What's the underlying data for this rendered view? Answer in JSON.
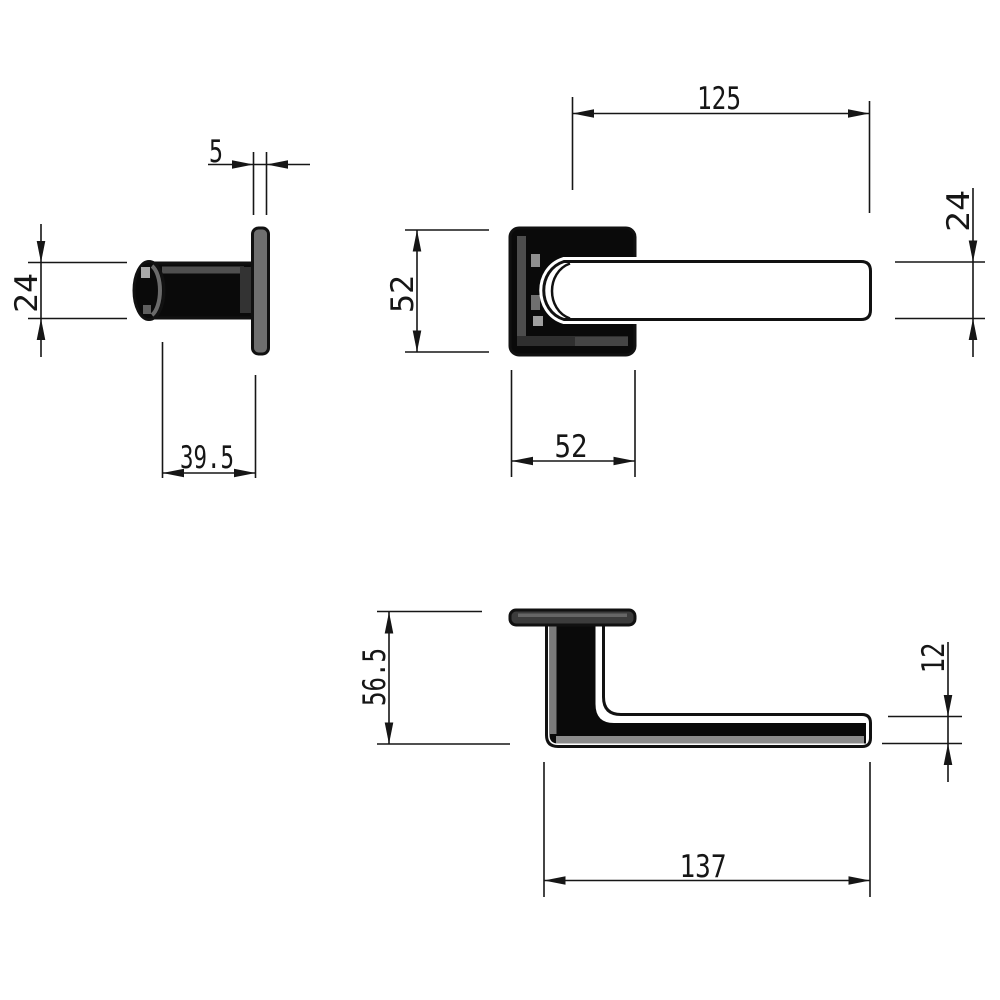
{
  "drawing": {
    "type": "technical-dimension-drawing",
    "subject": "door-lever-handle-three-views",
    "dimensions": {
      "plate_thickness": "5",
      "neck_diameter": "24",
      "neck_projection": "39.5",
      "lever_length": "125",
      "lever_height": "24",
      "rose_height": "52",
      "rose_width": "52",
      "handle_depth": "56.5",
      "lever_thickness": "12",
      "overall_length": "137"
    },
    "colors": {
      "line": "#161616",
      "fill_black": "#0a0a0a",
      "plate_gray": "#6f6f6f",
      "rose_plate_gray": "#3c3c3c",
      "highlight_gray": "#8c8c8c",
      "background": "#ffffff"
    }
  }
}
